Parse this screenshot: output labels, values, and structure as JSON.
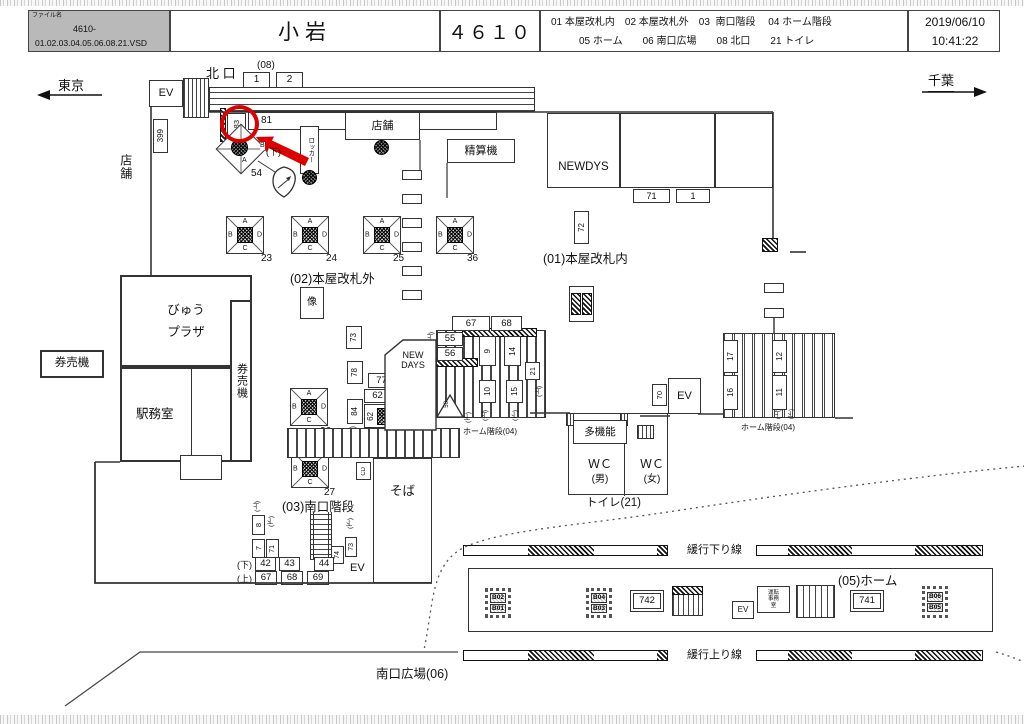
{
  "header": {
    "file_label": "ファイル名",
    "file_no": "4610-",
    "file_name": "01.02.03.04.05.06.08.21.VSD",
    "station_name": "小岩",
    "station_code": "４６１０",
    "legend_line1": "01 本屋改札内　02 本屋改札外　03  南口階段　 04 ホーム階段",
    "legend_line2": "05 ホーム　　06 南口広場　　08 北口　　21 トイレ",
    "date": "2019/06/10",
    "time": "10:41:22"
  },
  "directions": {
    "west": "東京",
    "east": "千葉"
  },
  "notes": {
    "up": "(上)",
    "down": "(下)"
  },
  "highlight_color": "#dd0000",
  "north_area": {
    "exit_label": "北 口",
    "exit_code": "(08)",
    "box1": "1",
    "box2": "2",
    "ev": "EV",
    "n399": "399",
    "store_side": "店舗",
    "n81": "81",
    "n83": "83",
    "locker": "ロッカー",
    "n54": "54",
    "letter_a": "A",
    "letter_b": "B"
  },
  "concourse": {
    "store": "店舗",
    "fare_machine": "精算機",
    "newdays": "NEWDYS",
    "n71": "71",
    "n1": "1",
    "n72": "72",
    "area01": "(01)本屋改札内",
    "area02": "(02)本屋改札外",
    "statue": "像",
    "view_plaza_1": "びゅう",
    "view_plaza_2": "プラザ",
    "ticket_machine": "券売機",
    "ticket_machine_v": "券売機",
    "station_office": "駅務室"
  },
  "pillars": {
    "letters": {
      "a": "A",
      "b": "B",
      "c": "C",
      "d": "D"
    },
    "p23": "23",
    "p24": "24",
    "p25": "25",
    "p36": "36",
    "p26": "26",
    "p27": "27"
  },
  "center": {
    "n73": "73",
    "n78": "78",
    "n77": "77",
    "n62a": "62",
    "n62b": "62",
    "n84": "84",
    "newdays_l1": "NEW",
    "newdays_l2": "DAYS",
    "n55": "55",
    "n56": "56",
    "n67": "67",
    "n68": "68",
    "n9": "9",
    "n14": "14",
    "n21": "21",
    "n10": "10",
    "n15": "15",
    "n50": "50",
    "home_stairs": "ホーム階段(04)"
  },
  "east_stairs": {
    "n17": "17",
    "n16": "16",
    "n12": "12",
    "n11": "11",
    "n70": "70",
    "ev": "EV",
    "home_stairs": "ホーム階段(04)"
  },
  "toilet": {
    "multi": "多機能",
    "wc": "ＷＣ",
    "male": "(男)",
    "female": "(女)",
    "label": "トイレ(21)"
  },
  "south": {
    "area03": "(03)南口階段",
    "soba": "そば",
    "cd": "CD",
    "ev": "EV",
    "n7": "7",
    "n8": "8",
    "n71": "71",
    "n73": "73",
    "n74": "74",
    "n42": "42",
    "n43": "43",
    "n44": "44",
    "n67": "67",
    "n68": "68",
    "n69": "69",
    "plaza": "南口広場(06)"
  },
  "platform": {
    "label": "(05)ホーム",
    "down_line": "緩行下り線",
    "up_line": "緩行上り線",
    "n742": "742",
    "n741": "741",
    "ev": "EV",
    "office_l1": "運転",
    "office_l2": "事務",
    "office_l3": "室",
    "b01": "B01",
    "b02": "B02",
    "b03": "B03",
    "b04": "B04",
    "b05": "B05",
    "b06": "B06"
  }
}
